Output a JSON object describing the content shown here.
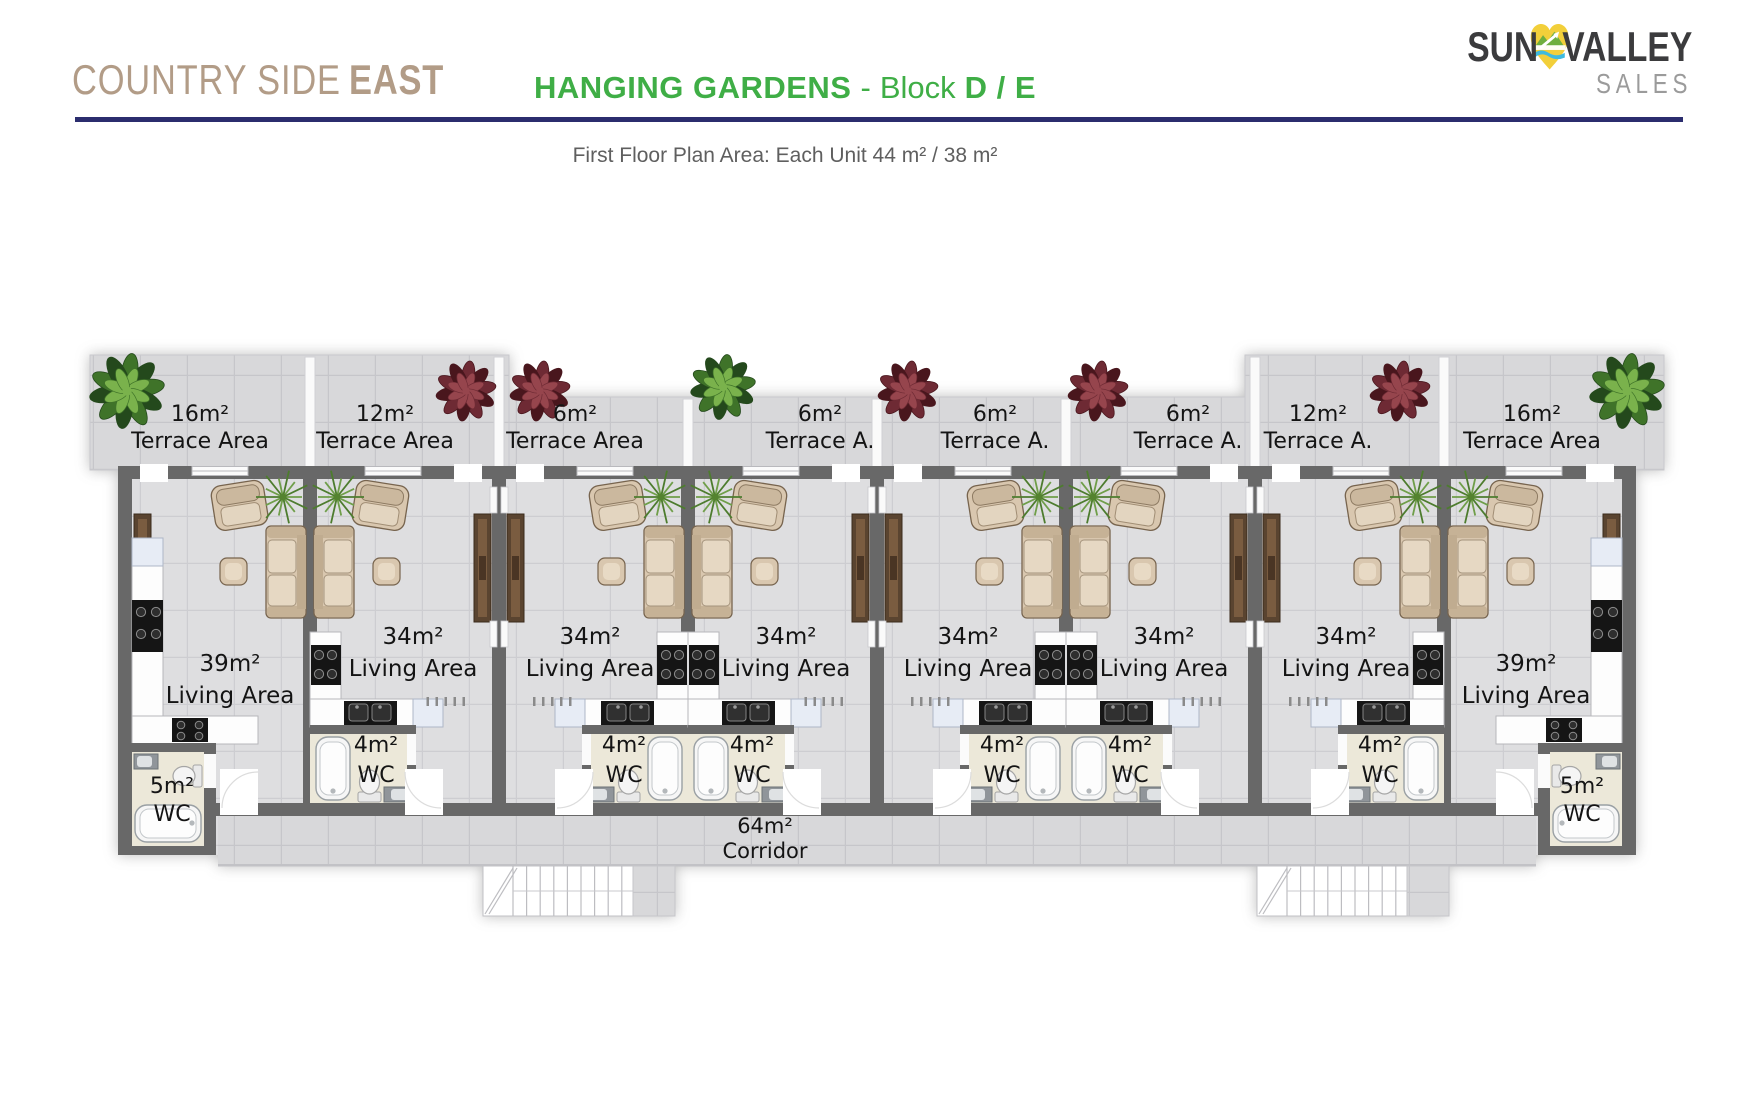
{
  "header": {
    "project": {
      "name_regular": "COUNTRY SIDE",
      "name_bold": "EAST"
    },
    "title": {
      "main": "HANGING GARDENS",
      "dash": "-",
      "block_word": "Block",
      "block_ids": "D / E"
    },
    "subtitle": "First Floor Plan Area: Each Unit 44 m² / 38 m²",
    "logo": {
      "word1": "SUN",
      "word2": "VALLEY",
      "word3": "SALES"
    },
    "colors": {
      "brand_tan": "#b29c87",
      "brand_green": "#3fae46",
      "rule_navy": "#2b2d6e",
      "logo_dark": "#3b3b3d",
      "logo_gray": "#9b9b9b",
      "logo_yellow": "#f2cf3a",
      "logo_leaf_green": "#6fae3e",
      "logo_water_blue": "#3fbade"
    }
  },
  "plan": {
    "terraces": [
      {
        "size": "16m²",
        "label": "Terrace Area"
      },
      {
        "size": "12m²",
        "label": "Terrace Area"
      },
      {
        "size": "6m²",
        "label": "Terrace Area"
      },
      {
        "size": "6m²",
        "label": "Terrace A."
      },
      {
        "size": "6m²",
        "label": "Terrace A."
      },
      {
        "size": "6m²",
        "label": "Terrace A."
      },
      {
        "size": "12m²",
        "label": "Terrace A."
      },
      {
        "size": "16m²",
        "label": "Terrace Area"
      }
    ],
    "units": [
      {
        "living_size": "39m²",
        "living_label": "Living Area",
        "wc_size": "5m²",
        "wc_label": "WC"
      },
      {
        "living_size": "34m²",
        "living_label": "Living Area",
        "wc_size": "4m²",
        "wc_label": "WC"
      },
      {
        "living_size": "34m²",
        "living_label": "Living Area",
        "wc_size": "4m²",
        "wc_label": "WC"
      },
      {
        "living_size": "34m²",
        "living_label": "Living Area",
        "wc_size": "4m²",
        "wc_label": "WC"
      },
      {
        "living_size": "34m²",
        "living_label": "Living Area",
        "wc_size": "4m²",
        "wc_label": "WC"
      },
      {
        "living_size": "34m²",
        "living_label": "Living Area",
        "wc_size": "4m²",
        "wc_label": "WC"
      },
      {
        "living_size": "34m²",
        "living_label": "Living Area",
        "wc_size": "4m²",
        "wc_label": "WC"
      },
      {
        "living_size": "39m²",
        "living_label": "Living Area",
        "wc_size": "5m²",
        "wc_label": "WC"
      }
    ],
    "corridor": {
      "size": "64m²",
      "label": "Corridor"
    }
  }
}
